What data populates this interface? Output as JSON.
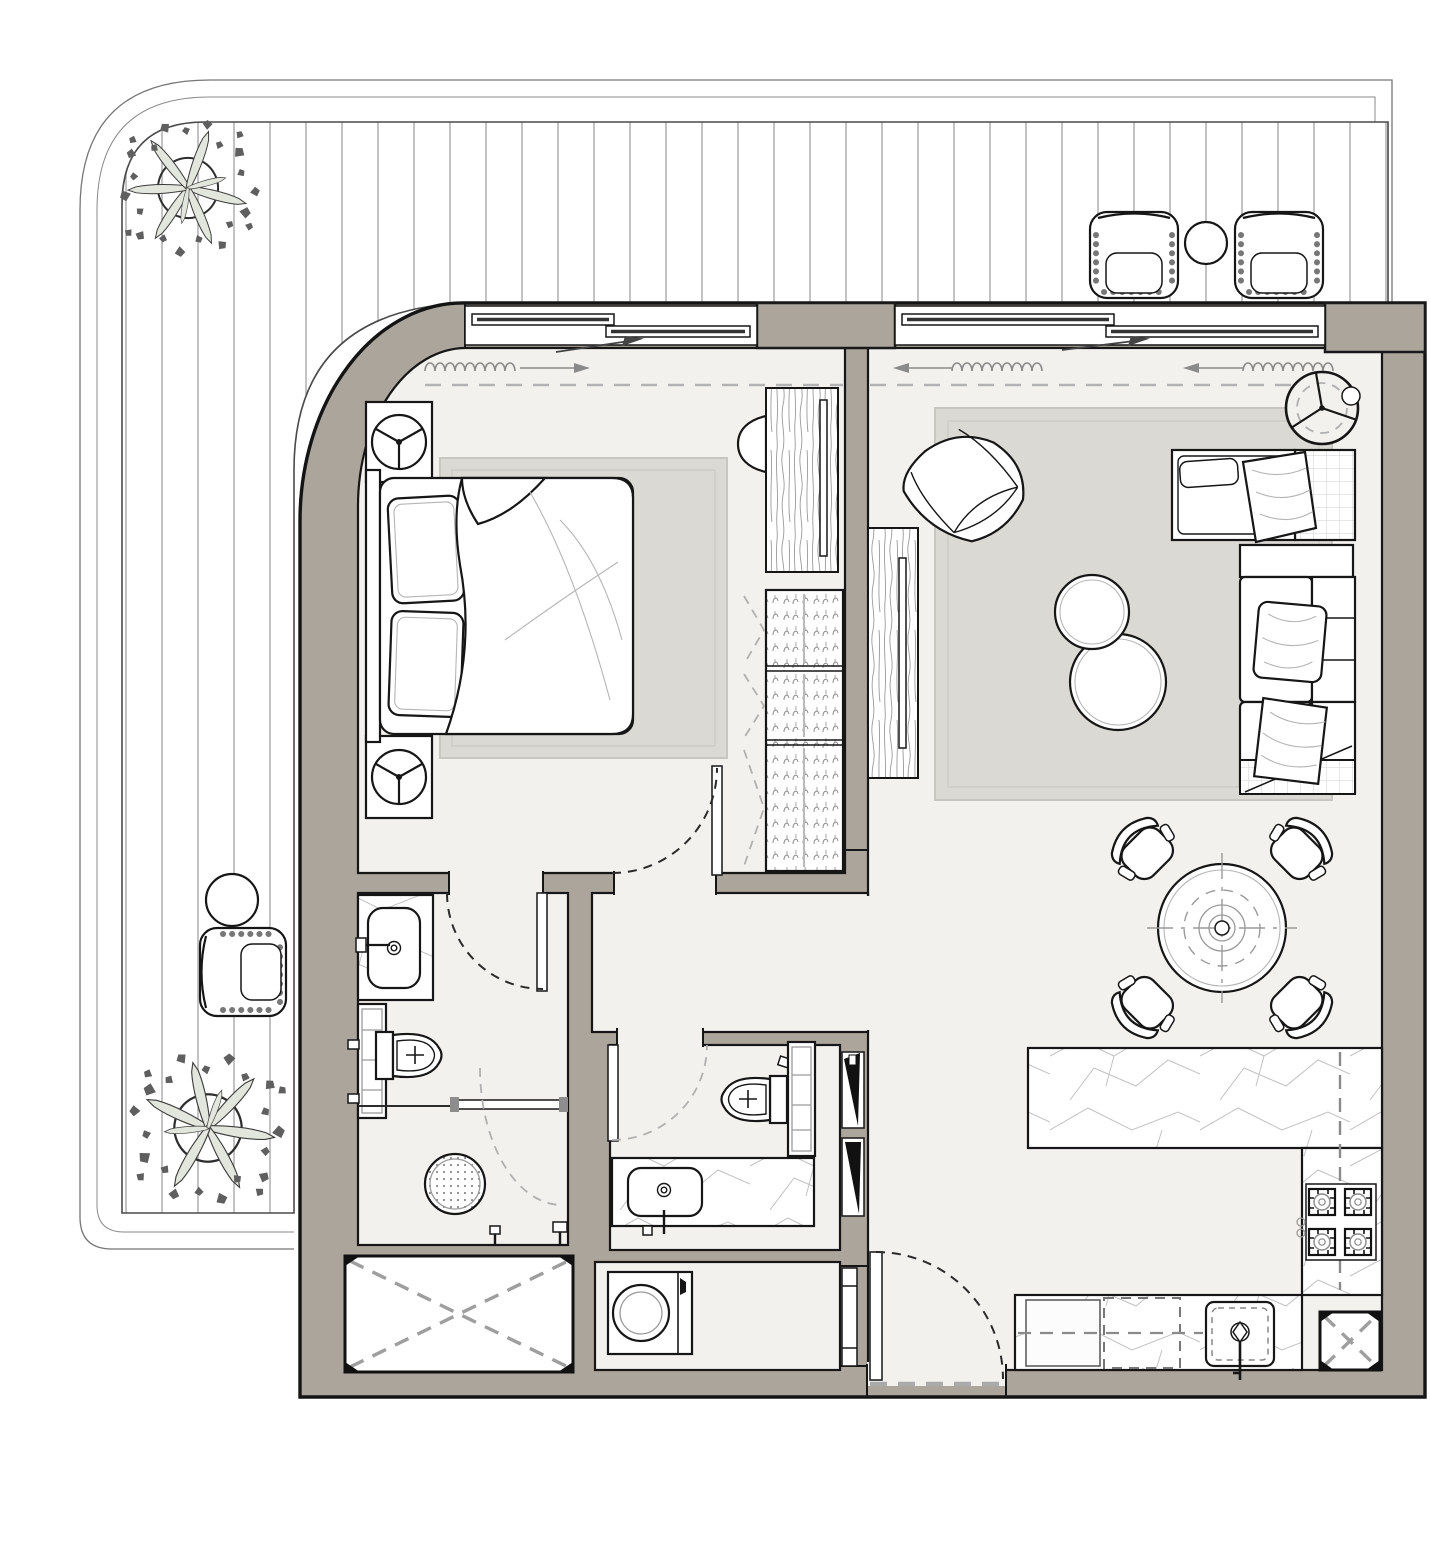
{
  "document": {
    "type": "architectural-floor-plan",
    "title": "One-bedroom apartment floor plan with wrap-around terrace",
    "visible_text": []
  },
  "colors": {
    "background": "#ffffff",
    "wall_fill": "#aba59c",
    "wall_outline": "#1a1a1a",
    "room_floor": "#f3f1ee",
    "rug": "#dad9d3",
    "furniture_fill": "#ffffff",
    "furniture_line": "#161616",
    "dashed_gray": "#b0b0b0",
    "deck_line": "#a3a3a3",
    "curtain_line": "#8a8a8a",
    "tree_leaf": "#5f5f5f",
    "tree_branch": "#e3e6dc",
    "marble_vein": "#c2c2c2",
    "niche_black": "#111111"
  },
  "areas": {
    "terrace": {
      "name": "wrap-around terrace",
      "items": [
        "deck boards",
        "tree (top-left)",
        "tree (bottom-left)",
        "wicker lounge chair x2 (top-right)",
        "round side table (top-right)",
        "wicker lounge chair (left)",
        "round side table (left)"
      ]
    },
    "bedroom": {
      "name": "bedroom",
      "items": [
        "double bed with duvet and two pillows",
        "headboard",
        "nightstand with lamp x2",
        "area rug",
        "dresser with TV",
        "half-round stool",
        "wardrobe with hanging rails (3 sections, bifold dashed doors)",
        "window with sliding panels",
        "curtain symbol",
        "door swing into room"
      ]
    },
    "living": {
      "name": "living / dining room",
      "items": [
        "area rug",
        "swivel armchair",
        "round coffee table x2 (nested)",
        "L-shaped sofa with chaise, cushions and throws",
        "console shelf",
        "floor lamp",
        "TV cabinet",
        "round dining table",
        "dining chair x4",
        "window with sliding panels",
        "curtain symbol"
      ]
    },
    "kitchen": {
      "name": "kitchen",
      "items": [
        "L-shaped stone counter",
        "4-burner gas hob",
        "under-counter sink with faucet",
        "dishwasher (dashed)",
        "base cabinet",
        "service shaft with X",
        "counter overhang dashed lines"
      ]
    },
    "ensuite_bathroom": {
      "name": "en-suite bathroom",
      "items": [
        "stone vanity with basin and wall faucet",
        "tall storage cabinet",
        "toilet",
        "walk-in shower with round drain",
        "glass screen",
        "dashed glass door swing",
        "wall fixtures",
        "door swing from bedroom"
      ]
    },
    "guest_bathroom": {
      "name": "guest bathroom",
      "items": [
        "toilet",
        "tall storage cabinet",
        "stone vanity with basin and faucet",
        "door swing with open leaf",
        "wall niches with black wedges"
      ]
    },
    "hallway": {
      "name": "hallway",
      "items": []
    },
    "laundry": {
      "name": "laundry closet",
      "items": [
        "washing machine",
        "sliding door"
      ]
    },
    "entry": {
      "name": "entry vestibule",
      "items": [
        "entry door with swing arc",
        "dashed threshold"
      ]
    },
    "shafts": {
      "name": "service voids",
      "items": [
        "large shaft with dashed X (bottom-left)",
        "small shaft with dashed X (bottom-right)"
      ]
    }
  },
  "icons": [
    "tree-icon",
    "wicker-chair-icon",
    "side-table-icon",
    "lamp-icon",
    "floor-lamp-icon",
    "bed-icon",
    "wardrobe-hanger-icon",
    "tv-icon",
    "sofa-icon",
    "armchair-icon",
    "coffee-table-icon",
    "dining-set-icon",
    "cooktop-icon",
    "sink-icon",
    "faucet-icon",
    "toilet-icon",
    "shower-drain-icon",
    "washing-machine-icon",
    "door-swing-icon",
    "curtain-icon",
    "shaft-x-icon",
    "window-icon"
  ]
}
